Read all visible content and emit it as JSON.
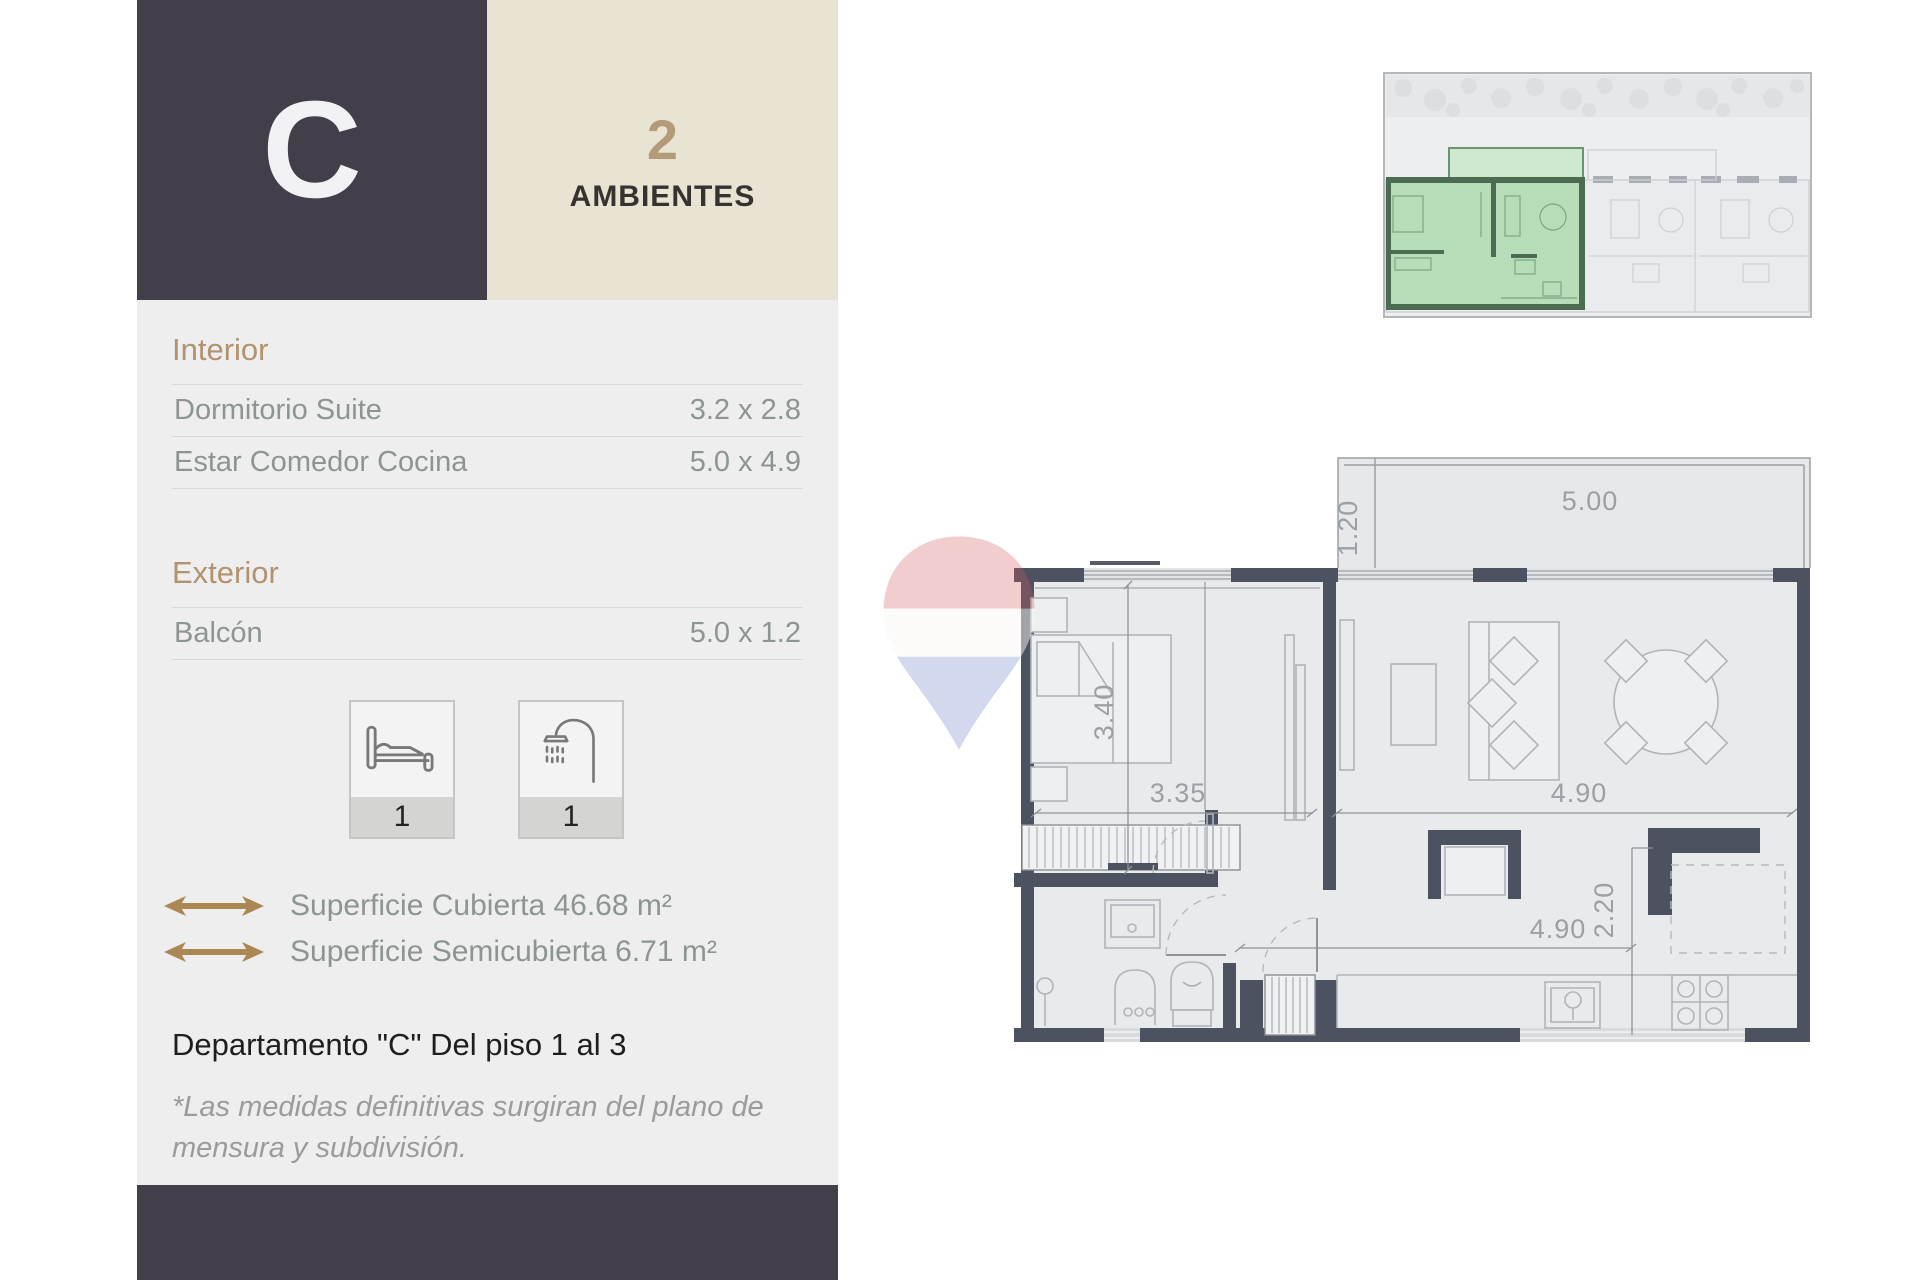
{
  "unit": {
    "letter": "C",
    "rooms_count": "2",
    "rooms_label": "AMBIENTES"
  },
  "interior": {
    "title": "Interior",
    "rows": [
      {
        "label": "Dormitorio Suite",
        "value": "3.2 x 2.8"
      },
      {
        "label": "Estar Comedor Cocina",
        "value": "5.0 x 4.9"
      }
    ]
  },
  "exterior": {
    "title": "Exterior",
    "rows": [
      {
        "label": "Balcón",
        "value": "5.0 x 1.2"
      }
    ]
  },
  "amenities": {
    "bedrooms": "1",
    "bathrooms": "1"
  },
  "surfaces": [
    {
      "label": "Superficie Cubierta 46.68 m²"
    },
    {
      "label": "Superficie Semicubierta 6.71 m²"
    }
  ],
  "floor_note": "Departamento \"C\" Del piso 1 al 3",
  "disclaimer": "*Las medidas definitivas surgiran del plano de mensura y subdivisión.",
  "plan": {
    "dims": {
      "balcony_width": "5.00",
      "balcony_depth": "1.20",
      "bedroom_depth": "3.40",
      "bedroom_width": "3.35",
      "living_width": "4.90",
      "kitchen_width": "4.90",
      "kitchen_depth": "2.20"
    }
  },
  "colors": {
    "accent_tan": "#b2936f",
    "dark": "#423e4a",
    "beige": "#e9e3d4",
    "panel_gray": "#eeeeee",
    "plan_wall": "#4d5261",
    "unit_highlight_green": "#b7ddb8",
    "watermark_red": "#cf5b5b",
    "watermark_blue": "#5b6fc0"
  }
}
